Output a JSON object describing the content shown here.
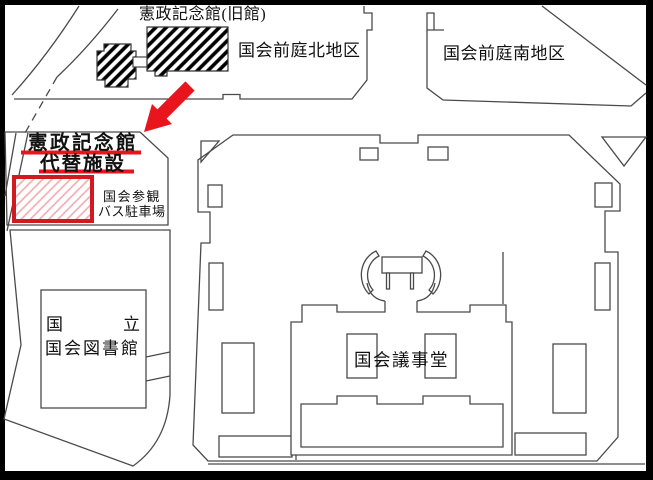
{
  "map": {
    "labels": {
      "kensei_old": "憲政記念館(旧館)",
      "north_garden": "国会前庭北地区",
      "south_garden": "国会前庭南地区",
      "kensei_new_line1": "憲政記念館",
      "kensei_new_line2": "代替施設",
      "bus_parking_line1": "国会参観",
      "bus_parking_line2": "バス駐車場",
      "library_line1_left": "国",
      "library_line1_right": "立",
      "library_line2": "国会図書館",
      "diet_building": "国会議事堂"
    },
    "colors": {
      "highlight_red": "#e8151d",
      "site_border_red": "#cf1a22",
      "site_hatch_pink": "#efaab0",
      "outline_gray": "#4a4a4a",
      "frame_black": "#000000"
    }
  }
}
